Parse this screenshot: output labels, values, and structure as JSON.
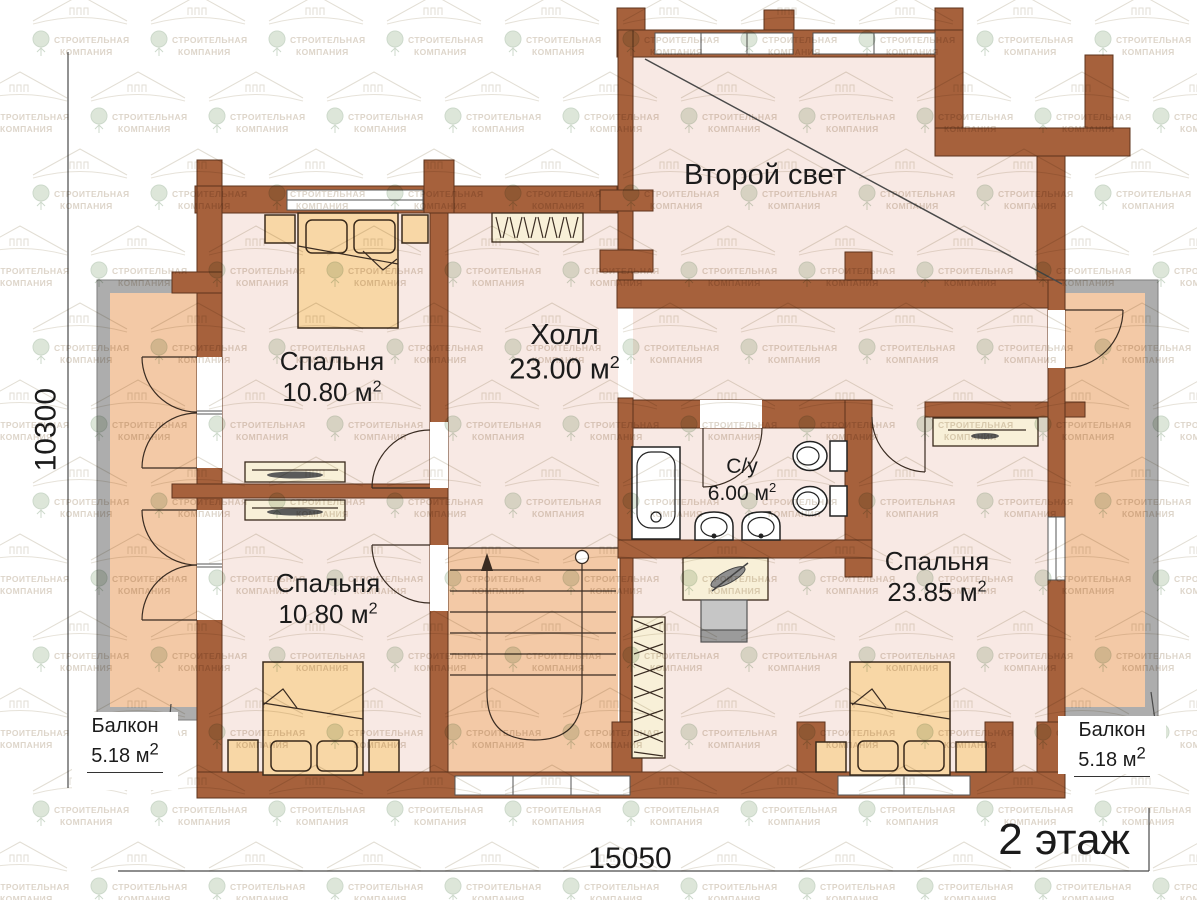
{
  "floor_plan": {
    "title": "2 этаж",
    "rooms": {
      "second_light": {
        "name": "Второй свет"
      },
      "hall": {
        "name": "Холл",
        "area": "23.00 м",
        "sup": "2"
      },
      "bedroom_top_left": {
        "name": "Спальня",
        "area": "10.80 м",
        "sup": "2"
      },
      "bedroom_bottom_left": {
        "name": "Спальня",
        "area": "10.80 м",
        "sup": "2"
      },
      "bedroom_right": {
        "name": "Спальня",
        "area": "23.85 м",
        "sup": "2"
      },
      "bathroom": {
        "name": "С/у",
        "area": "6.00 м",
        "sup": "2"
      },
      "balcony_left": {
        "name": "Балкон",
        "area": "5.18 м",
        "sup": "2"
      },
      "balcony_right": {
        "name": "Балкон",
        "area": "5.18 м",
        "sup": "2"
      }
    },
    "dimensions": {
      "width": "15050",
      "height": "10300"
    },
    "watermark": {
      "line1": "СТРОИТЕЛЬНАЯ",
      "line2": "КОМПАНИЯ"
    },
    "colors": {
      "wall": "#a6613c",
      "floor": "#f8e9e4",
      "accent_warm": "#f3c9a6",
      "furniture": "#f8d7a6",
      "outer_wall_gray": "#adadad"
    }
  }
}
